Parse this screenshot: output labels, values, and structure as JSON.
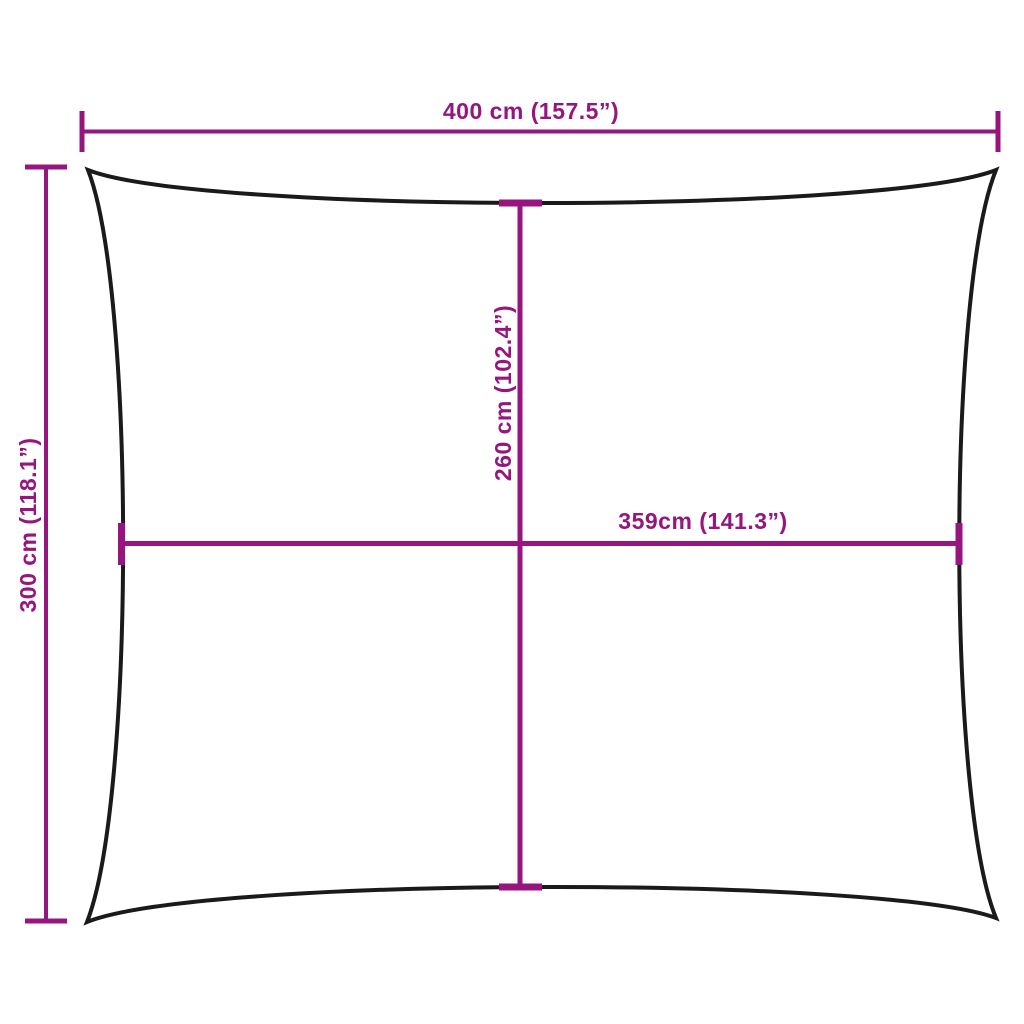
{
  "diagram": {
    "kind": "product-dimension-diagram",
    "shape": "rectangle-with-concave-edges"
  },
  "dimensions": {
    "overall_width": "400 cm (157.5”)",
    "overall_height": "300 cm (118.1”)",
    "center_height": "260 cm (102.4”)",
    "center_width": "359cm (141.3”)"
  },
  "colors": {
    "dimension_accent": "#96157F",
    "shape_outline": "#1A1A1A",
    "background": "#FFFFFF"
  }
}
